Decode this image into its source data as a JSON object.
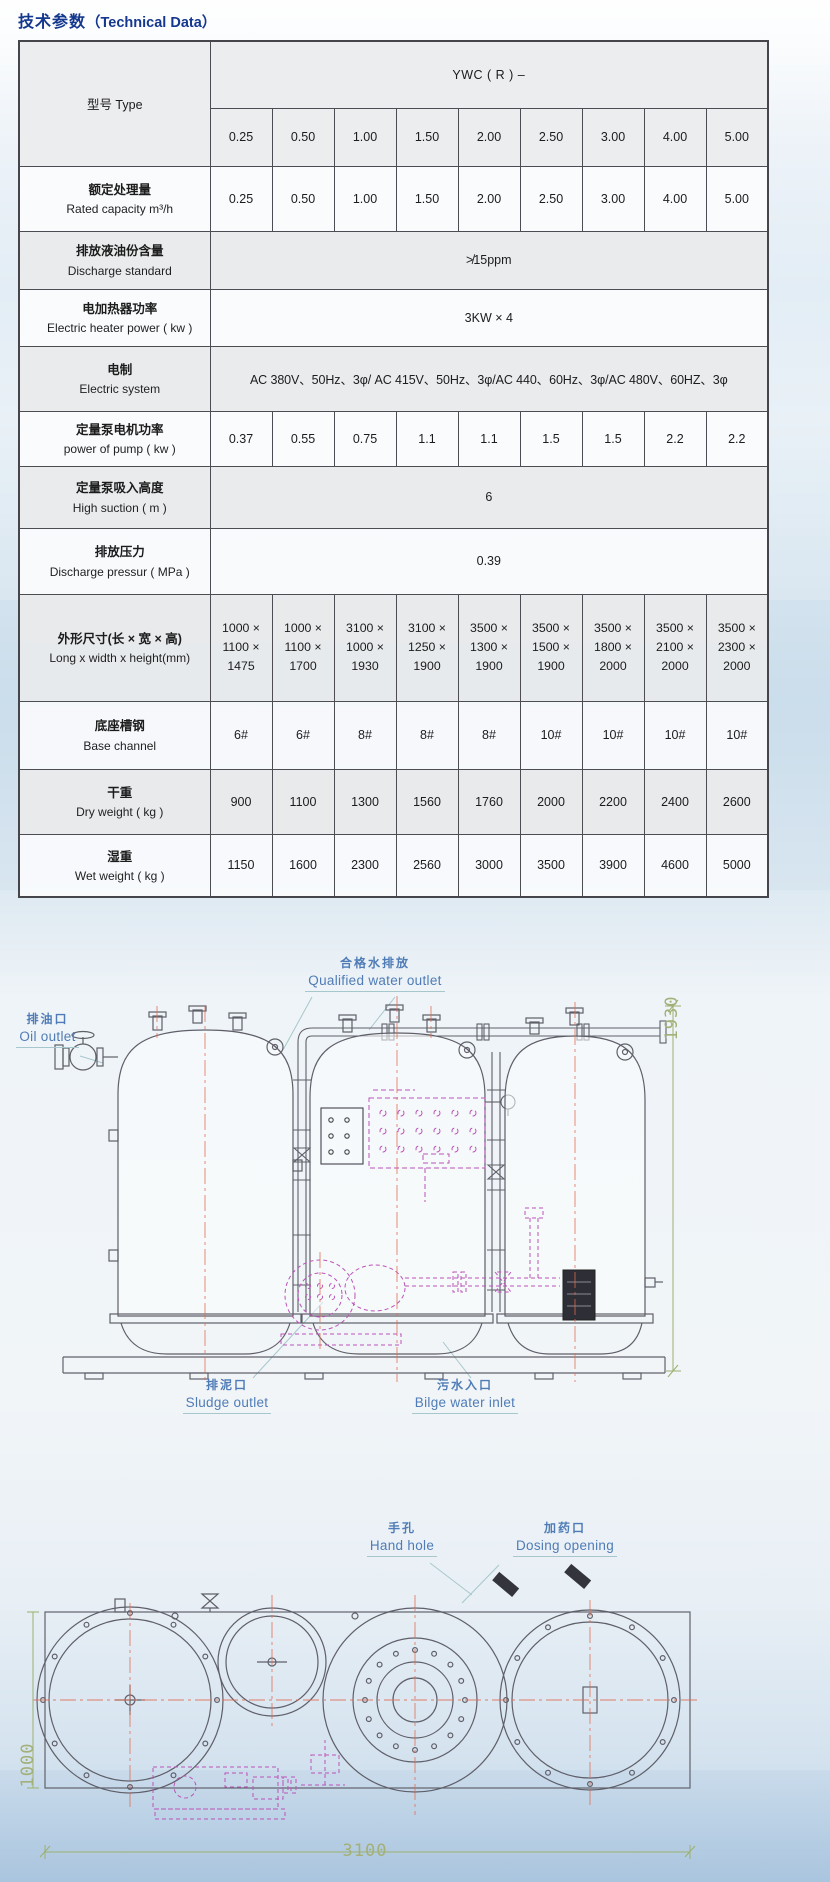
{
  "header": {
    "title_zh": "技术参数",
    "title_en": "（Technical Data）"
  },
  "table": {
    "type_label": "型号 Type",
    "series_header": "YWC ( R ) –",
    "models": [
      "0.25",
      "0.50",
      "1.00",
      "1.50",
      "2.00",
      "2.50",
      "3.00",
      "4.00",
      "5.00"
    ],
    "rows": [
      {
        "zh": "额定处理量",
        "en": "Rated capacity  m³/h",
        "values": [
          "0.25",
          "0.50",
          "1.00",
          "1.50",
          "2.00",
          "2.50",
          "3.00",
          "4.00",
          "5.00"
        ]
      },
      {
        "zh": "排放液油份含量",
        "en": "Discharge standard",
        "span": "≯15ppm"
      },
      {
        "zh": "电加热器功率",
        "en": "Electric heater power ( kw )",
        "span": "3KW × 4"
      },
      {
        "zh": "电制",
        "en": "Electric system",
        "span": "AC 380V、50Hz、3φ/ AC 415V、50Hz、3φ/AC 440、60Hz、3φ/AC 480V、60HZ、3φ"
      },
      {
        "zh": "定量泵电机功率",
        "en": "power of pump ( kw )",
        "values": [
          "0.37",
          "0.55",
          "0.75",
          "1.1",
          "1.1",
          "1.5",
          "1.5",
          "2.2",
          "2.2"
        ]
      },
      {
        "zh": "定量泵吸入高度",
        "en": "High suction  ( m )",
        "span": "6"
      },
      {
        "zh": "排放压力",
        "en": "Discharge pressur ( MPa )",
        "span": "0.39"
      },
      {
        "zh": "外形尺寸(长 × 宽 × 高)",
        "en": "Long x width x height(mm)",
        "values": [
          [
            "1000 ×",
            "1100 ×",
            "1475"
          ],
          [
            "1000 ×",
            "1100 ×",
            "1700"
          ],
          [
            "3100 ×",
            "1000 ×",
            "1930"
          ],
          [
            "3100 ×",
            "1250 ×",
            "1900"
          ],
          [
            "3500 ×",
            "1300 ×",
            "1900"
          ],
          [
            "3500 ×",
            "1500 ×",
            "1900"
          ],
          [
            "3500 ×",
            "1800 ×",
            "2000"
          ],
          [
            "3500 ×",
            "2100 ×",
            "2000"
          ],
          [
            "3500 ×",
            "2300 ×",
            "2000"
          ]
        ]
      },
      {
        "zh": "底座槽钢",
        "en": "Base channel",
        "values": [
          "6#",
          "6#",
          "8#",
          "8#",
          "8#",
          "10#",
          "10#",
          "10#",
          "10#"
        ]
      },
      {
        "zh": "干重",
        "en": "Dry weight  ( kg )",
        "values": [
          "900",
          "1100",
          "1300",
          "1560",
          "1760",
          "2000",
          "2200",
          "2400",
          "2600"
        ]
      },
      {
        "zh": "湿重",
        "en": "Wet weight  ( kg )",
        "values": [
          "1150",
          "1600",
          "2300",
          "2560",
          "3000",
          "3500",
          "3900",
          "4600",
          "5000"
        ]
      }
    ]
  },
  "elevation": {
    "labels": {
      "qualified_water": {
        "zh": "合格水排放",
        "en": "Qualified water outlet"
      },
      "oil_outlet": {
        "zh": "排油口",
        "en": "Oil outlet"
      },
      "sludge_outlet": {
        "zh": "排泥口",
        "en": "Sludge outlet"
      },
      "bilge_inlet": {
        "zh": "污水入口",
        "en": "Bilge water inlet"
      }
    },
    "dimension_height": "1930"
  },
  "plan": {
    "labels": {
      "hand_hole": {
        "zh": "手孔",
        "en": "Hand hole"
      },
      "dosing_opening": {
        "zh": "加药口",
        "en": "Dosing opening"
      }
    },
    "dimension_length": "3100",
    "dimension_width": "1000"
  }
}
